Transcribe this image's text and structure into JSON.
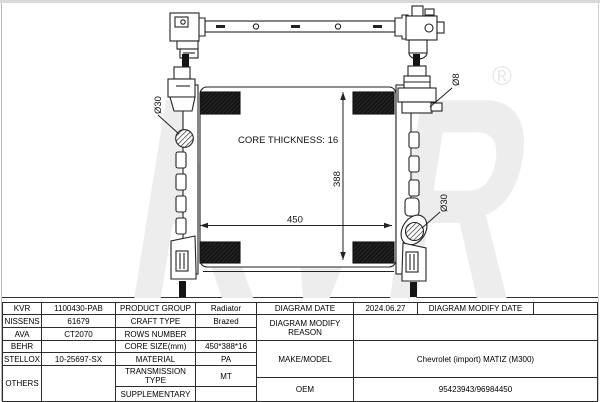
{
  "watermark": {
    "text": "KVR",
    "registered": "®"
  },
  "diagram": {
    "core_thickness_label": "CORE THICKNESS: 16",
    "dim_width": "450",
    "dim_height": "388",
    "inlet_diameter": "Ø30",
    "outlet_diameter": "Ø30",
    "filler_diameter": "Ø8"
  },
  "table": {
    "left": {
      "rows": [
        {
          "brand": "KVR",
          "code": "1100430-PAB",
          "label": "PRODUCT GROUP",
          "value": "Radiator"
        },
        {
          "brand": "NISSENS",
          "code": "61679",
          "label": "CRAFT TYPE",
          "value": "Brazed"
        },
        {
          "brand": "AVA",
          "code": "CT2070",
          "label": "ROWS NUMBER",
          "value": ""
        },
        {
          "brand": "BEHR",
          "code": "",
          "label": "CORE SIZE(mm)",
          "value": "450*388*16"
        },
        {
          "brand": "STELLOX",
          "code": "10-25697-SX",
          "label": "MATERIAL",
          "value": "PA"
        },
        {
          "brand": "OTHERS",
          "code": "",
          "label": "TRANSMISSION TYPE",
          "value": "MT"
        },
        {
          "label": "SUPPLEMENTARY",
          "value": ""
        }
      ]
    },
    "right": {
      "diagram_date_label": "DIAGRAM DATE",
      "diagram_date": "2024.06.27",
      "diagram_modify_date_label": "DIAGRAM MODIFY DATE",
      "diagram_modify_date": "",
      "modify_reason_label": "DIAGRAM MODIFY REASON",
      "modify_reason": "",
      "make_model_label": "MAKE/MODEL",
      "make_model": "Chevrolet (import) MATIZ (M300)",
      "oem_label": "OEM",
      "oem": "95423943/96984450"
    }
  }
}
